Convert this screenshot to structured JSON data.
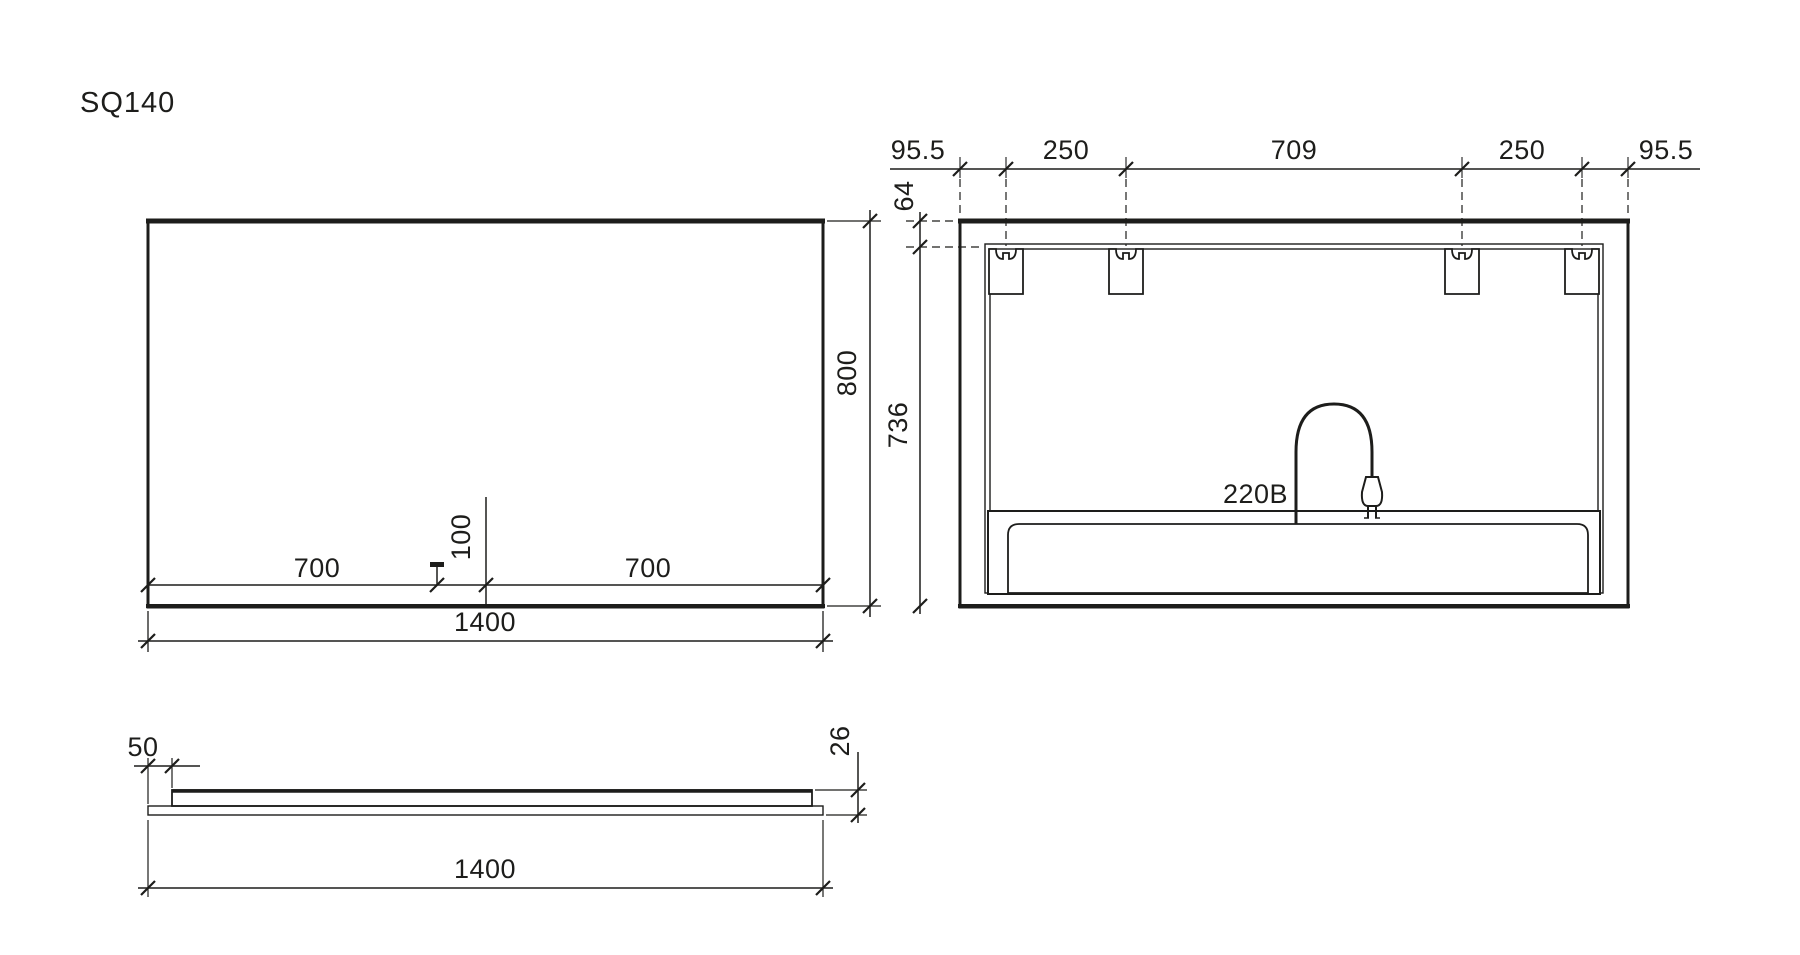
{
  "title": "SQ140",
  "colors": {
    "line": "#1d1d1b",
    "background": "#ffffff"
  },
  "front_view": {
    "label": "front view of mirror",
    "dim_left_half": "700",
    "dim_sensor_offset": "100",
    "dim_right_half": "700",
    "dim_height": "800",
    "dim_width_total": "1400"
  },
  "rear_view": {
    "label": "rear view of mirror with mounting brackets",
    "dim_margin_left": "95.5",
    "dim_bracket_spacing_left": "250",
    "dim_bracket_span_center": "709",
    "dim_bracket_spacing_right": "250",
    "dim_margin_right": "95.5",
    "dim_top_offset": "64",
    "dim_body_height": "736",
    "power_label": "220B"
  },
  "side_view": {
    "label": "side profile of mirror",
    "dim_backing_inset": "50",
    "dim_thickness": "26",
    "dim_width_total": "1400"
  }
}
